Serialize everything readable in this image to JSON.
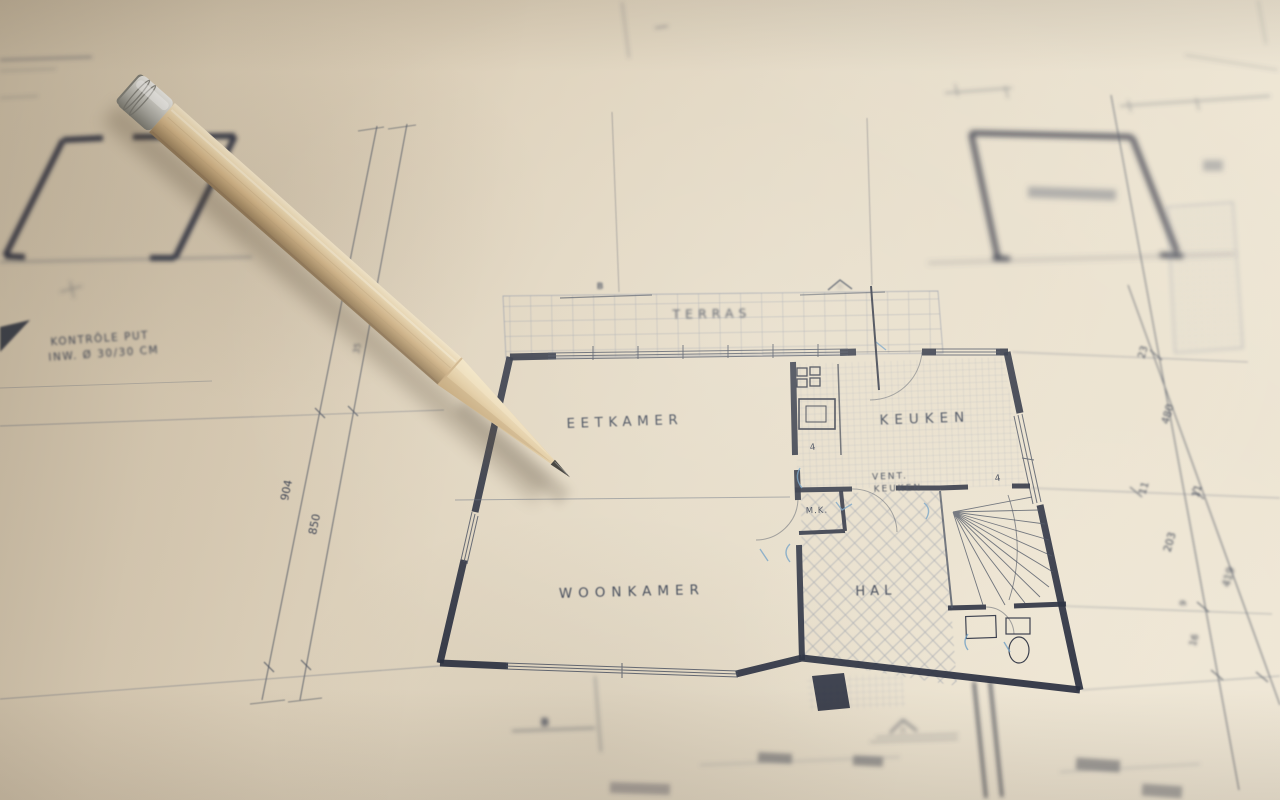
{
  "labels": {
    "terras": "TERRAS",
    "eetkamer": "EETKAMER",
    "keuken": "KEUKEN",
    "vent_keuken_line1": "VENT.",
    "vent_keuken_line2": "KEUKEN",
    "meterkast": "M.K.",
    "woonkamer": "WOONKAMER",
    "hal": "HAL",
    "vent_symbol": "4"
  },
  "notes": {
    "kontrole_line1": "KONTRÔLE PUT",
    "kontrole_line2": "INW. Ø 30/30 CM"
  },
  "sections": {
    "top_b": "B",
    "top_a": "A",
    "bottom_b": "B",
    "bottom_a": "A"
  },
  "dimensions": {
    "left": [
      "904",
      "850"
    ],
    "mid": "35",
    "right": [
      "23",
      "480",
      "11",
      "11",
      "203",
      "419",
      "9",
      "16"
    ]
  },
  "colors": {
    "paper": "#e0d5c0",
    "ink_dark": "#2a3040",
    "ink_medium": "#4a5160",
    "ink_light": "#97a0b0",
    "note_blue": "#6f9fc4",
    "pencil_wood": "#d8bf96",
    "pencil_graphite": "#35332f",
    "pencil_ferrule": "#cdccc8"
  }
}
